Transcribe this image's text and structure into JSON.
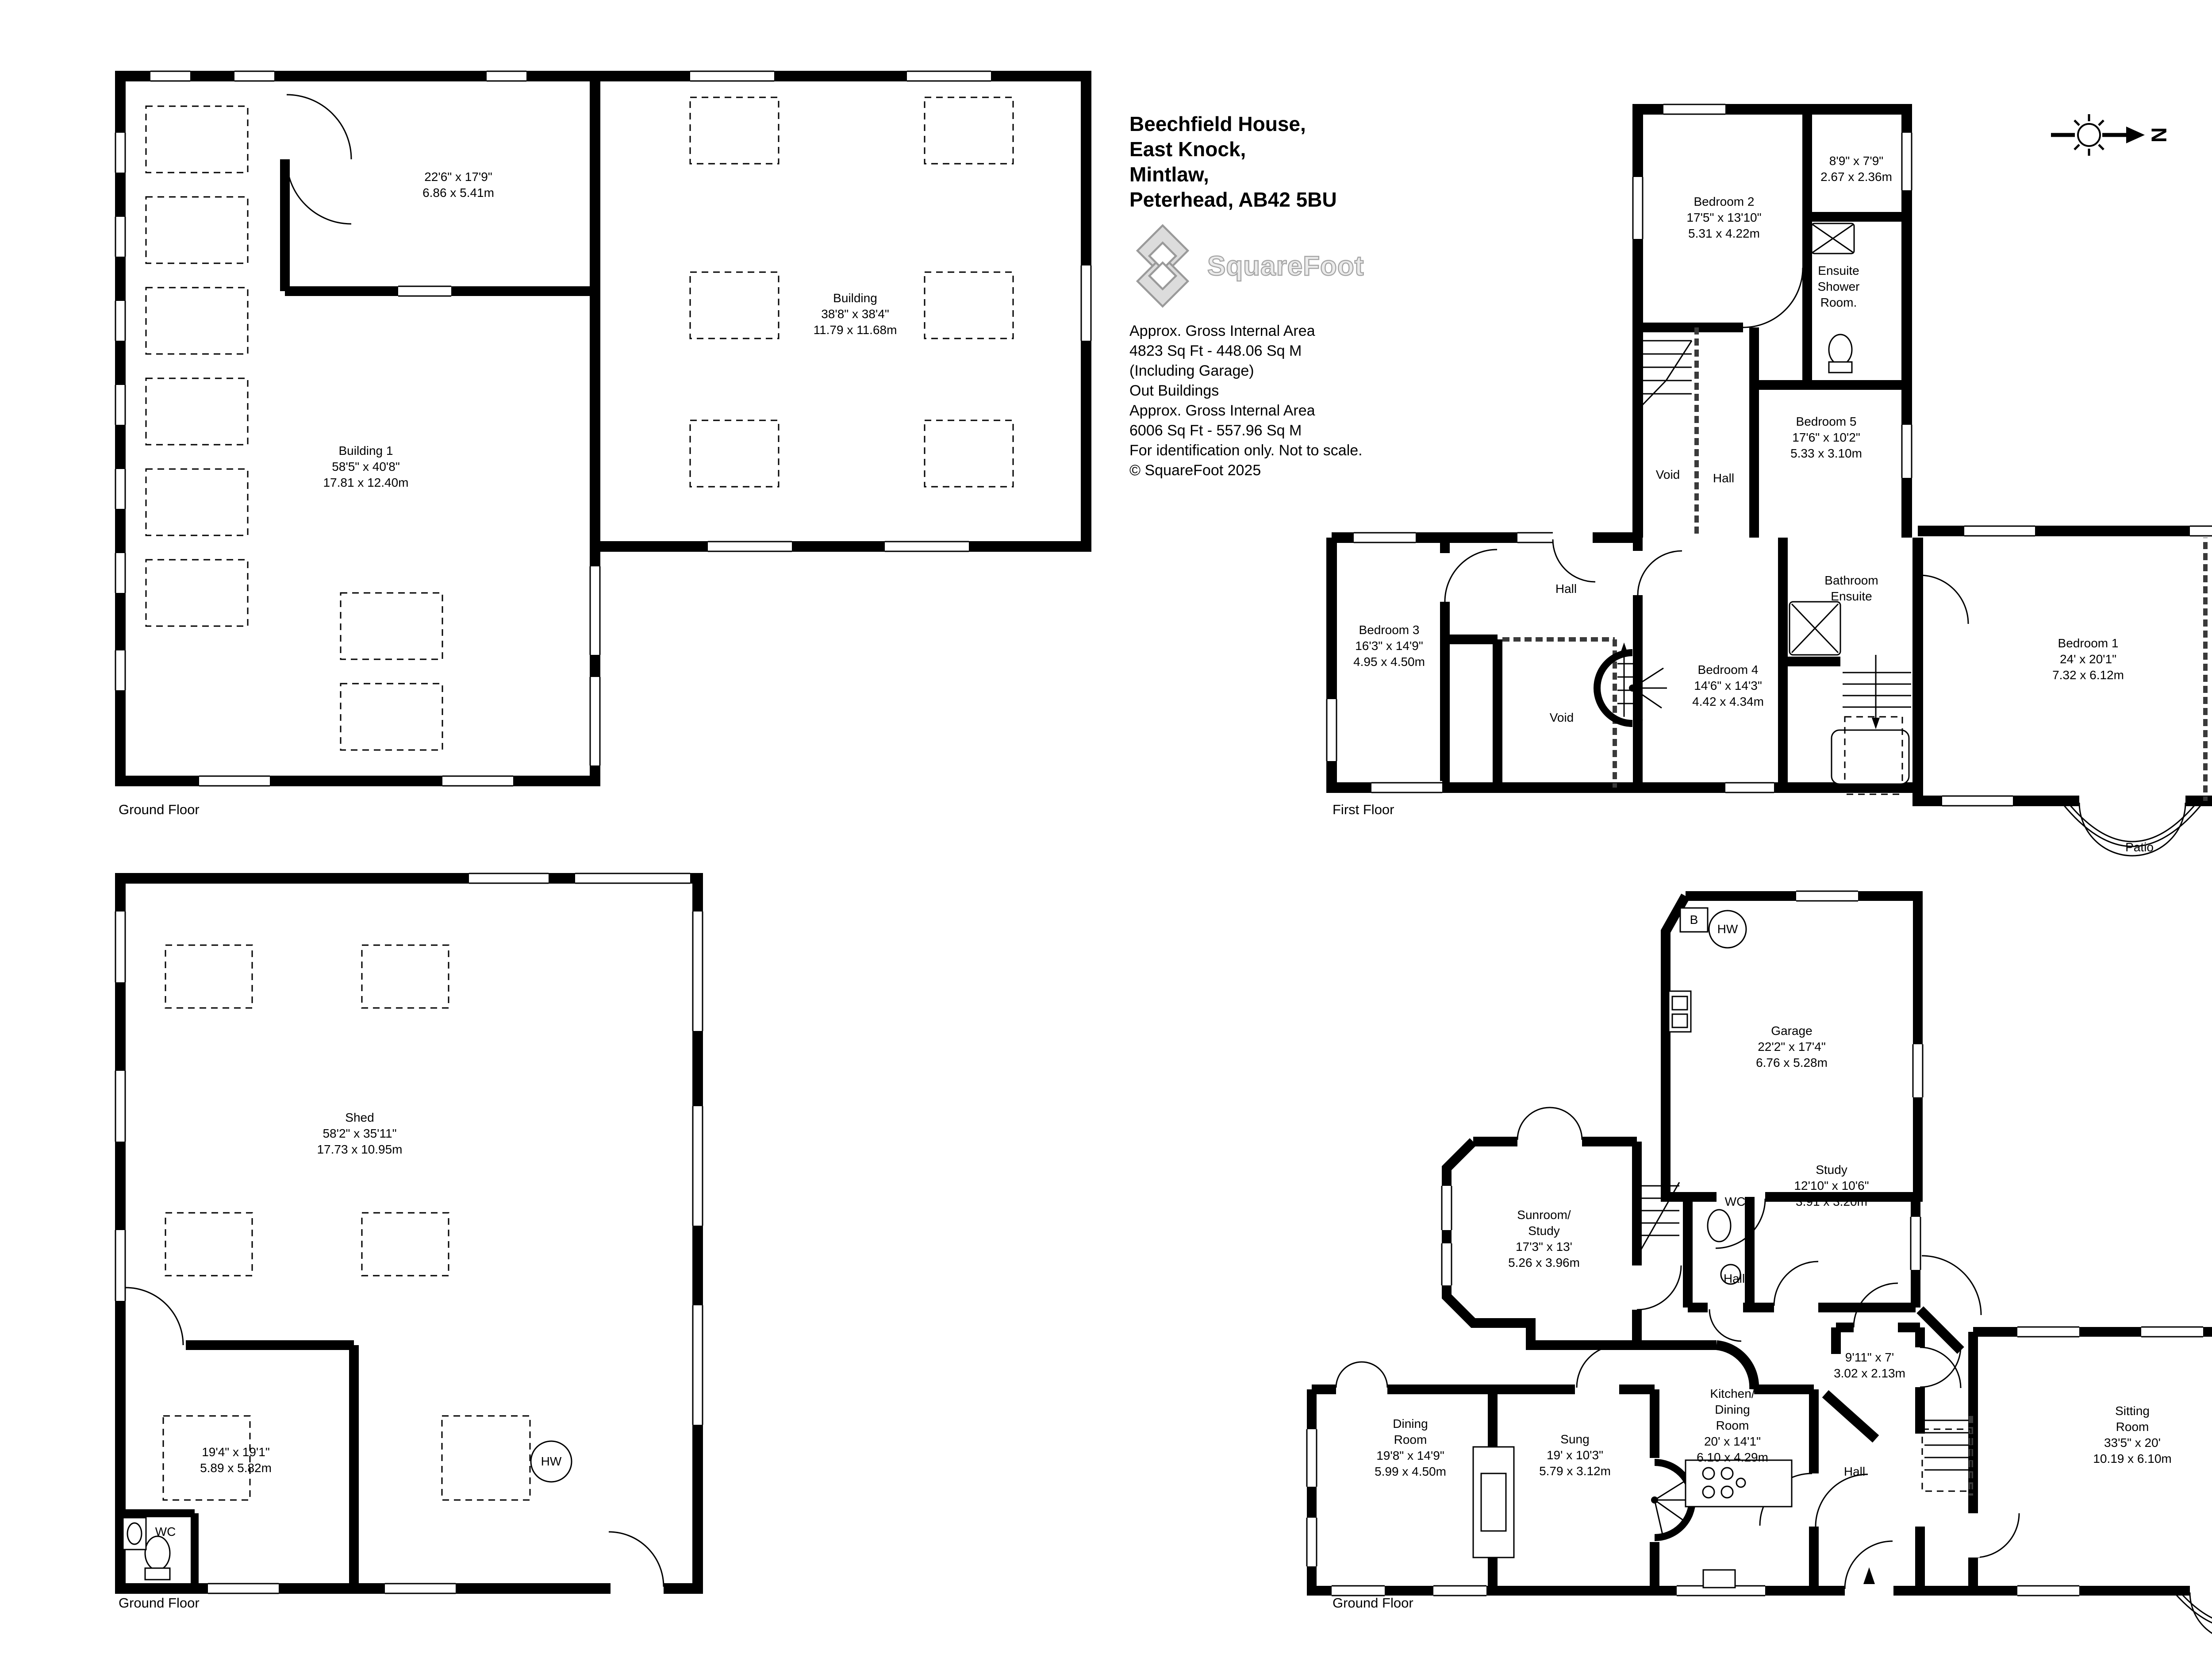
{
  "title_block": {
    "address_lines": [
      "Beechfield House,",
      "East Knock,",
      "Mintlaw,",
      "Peterhead, AB42 5BU"
    ],
    "logo_text": "SquareFoot",
    "detail_lines": [
      "Approx. Gross Internal Area",
      "4823 Sq Ft  -  448.06 Sq M",
      "(Including Garage)",
      "Out Buildings",
      "Approx. Gross Internal Area",
      "6006 Sq Ft  -  557.96 Sq M",
      "For identification only. Not to scale.",
      "© SquareFoot 2025"
    ]
  },
  "compass": {
    "label": "N"
  },
  "colors": {
    "walls": "#000000",
    "background": "#ffffff",
    "logo_gray": "#a6a6a6"
  },
  "plans": {
    "outbuildings": {
      "floor_label": "Ground Floor",
      "rooms": {
        "room_22_6": {
          "lines": [
            "22'6\" x 17'9\"",
            "6.86 x 5.41m"
          ]
        },
        "building": {
          "lines": [
            "Building",
            "38'8\" x 38'4\"",
            "11.79 x 11.68m"
          ]
        },
        "building_1": {
          "lines": [
            "Building 1",
            "58'5\" x 40'8\"",
            "17.81 x 12.40m"
          ]
        }
      }
    },
    "first_floor": {
      "floor_label": "First Floor",
      "rooms": {
        "room_8_9": {
          "lines": [
            "8'9\" x 7'9\"",
            "2.67 x 2.36m"
          ]
        },
        "bedroom_2": {
          "lines": [
            "Bedroom 2",
            "17'5\" x 13'10\"",
            "5.31 x 4.22m"
          ]
        },
        "ensuite_shower": {
          "lines": [
            "Ensuite",
            "Shower",
            "Room."
          ]
        },
        "bedroom_5": {
          "lines": [
            "Bedroom 5",
            "17'6\" x 10'2\"",
            "5.33 x 3.10m"
          ]
        },
        "void_upper": {
          "lines": [
            "Void"
          ]
        },
        "hall_upper": {
          "lines": [
            "Hall"
          ]
        },
        "bedroom_3": {
          "lines": [
            "Bedroom 3",
            "16'3\" x 14'9\"",
            "4.95 x 4.50m"
          ]
        },
        "hall_main": {
          "lines": [
            "Hall"
          ]
        },
        "bedroom_4": {
          "lines": [
            "Bedroom 4",
            "14'6\" x 14'3\"",
            "4.42 x 4.34m"
          ]
        },
        "void_main": {
          "lines": [
            "Void"
          ]
        },
        "bathroom_ensuite": {
          "lines": [
            "Bathroom",
            "Ensuite"
          ]
        },
        "bedroom_1": {
          "lines": [
            "Bedroom 1",
            "24' x 20'1\"",
            "7.32 x 6.12m"
          ]
        },
        "void_right": {
          "lines": [
            "Void"
          ]
        },
        "patio": {
          "lines": [
            "Patio"
          ]
        }
      }
    },
    "shed": {
      "floor_label": "Ground Floor",
      "rooms": {
        "shed": {
          "lines": [
            "Shed",
            "58'2\" x 35'11\"",
            "17.73 x 10.95m"
          ]
        },
        "room_19_4": {
          "lines": [
            "19'4\" x 19'1\"",
            "5.89 x 5.82m"
          ]
        },
        "wc": {
          "lines": [
            "WC"
          ]
        },
        "hw": {
          "lines": [
            "HW"
          ]
        }
      }
    },
    "house_ground": {
      "floor_label": "Ground Floor",
      "rooms": {
        "boiler": {
          "lines": [
            "B"
          ]
        },
        "hw": {
          "lines": [
            "HW"
          ]
        },
        "garage": {
          "lines": [
            "Garage",
            "22'2\" x 17'4\"",
            "6.76 x 5.28m"
          ]
        },
        "sunroom_study": {
          "lines": [
            "Sunroom/",
            "Study",
            "17'3\" x 13'",
            "5.26 x 3.96m"
          ]
        },
        "wc": {
          "lines": [
            "WC"
          ]
        },
        "study": {
          "lines": [
            "Study",
            "12'10\" x 10'6\"",
            "3.91 x 3.20m"
          ]
        },
        "hall": {
          "lines": [
            "Hall"
          ]
        },
        "room_9_11": {
          "lines": [
            "9'11\" x 7'",
            "3.02 x 2.13m"
          ]
        },
        "dining_room": {
          "lines": [
            "Dining",
            "Room",
            "19'8\" x 14'9\"",
            "5.99 x 4.50m"
          ]
        },
        "sung": {
          "lines": [
            "Sung",
            "19' x 10'3\"",
            "5.79 x 3.12m"
          ]
        },
        "kitchen_dining": {
          "lines": [
            "Kitchen/",
            "Dining",
            "Room",
            "20' x 14'1\"",
            "6.10 x 4.29m"
          ]
        },
        "hall_2": {
          "lines": [
            "Hall"
          ]
        },
        "sitting_room": {
          "lines": [
            "Sitting",
            "Room",
            "33'5\" x 20'",
            "10.19 x 6.10m"
          ]
        }
      }
    }
  }
}
